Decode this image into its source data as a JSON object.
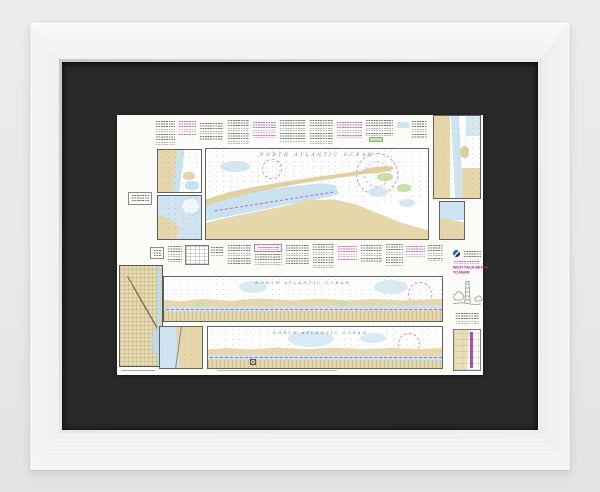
{
  "photo": {
    "background_color": "#eaeaea",
    "frame_color": "#f5f5f3",
    "mat_color": "#282828"
  },
  "chart": {
    "paper_color": "#fbfbf7",
    "palette": {
      "land_tan": "#e6d7ab",
      "shallow_water_blue": "#c9e2ef",
      "marsh_green": "#c8dfa8",
      "nautical_magenta": "#c2188f",
      "ink": "#3a3a3a",
      "soundings_gray_blue": "#7e97ab"
    },
    "top_panel": {
      "ocean_label": "NORTH ATLANTIC OCEAN"
    },
    "strip1": {
      "ocean_label": "NORTH ATLANTIC OCEAN"
    },
    "strip2": {
      "ocean_label": "NORTH ATLANTIC OCEAN"
    },
    "title_block": {
      "line1": "WEST PALM BEACH",
      "line2": "TO MIAMI",
      "color": "#c2188f"
    }
  }
}
